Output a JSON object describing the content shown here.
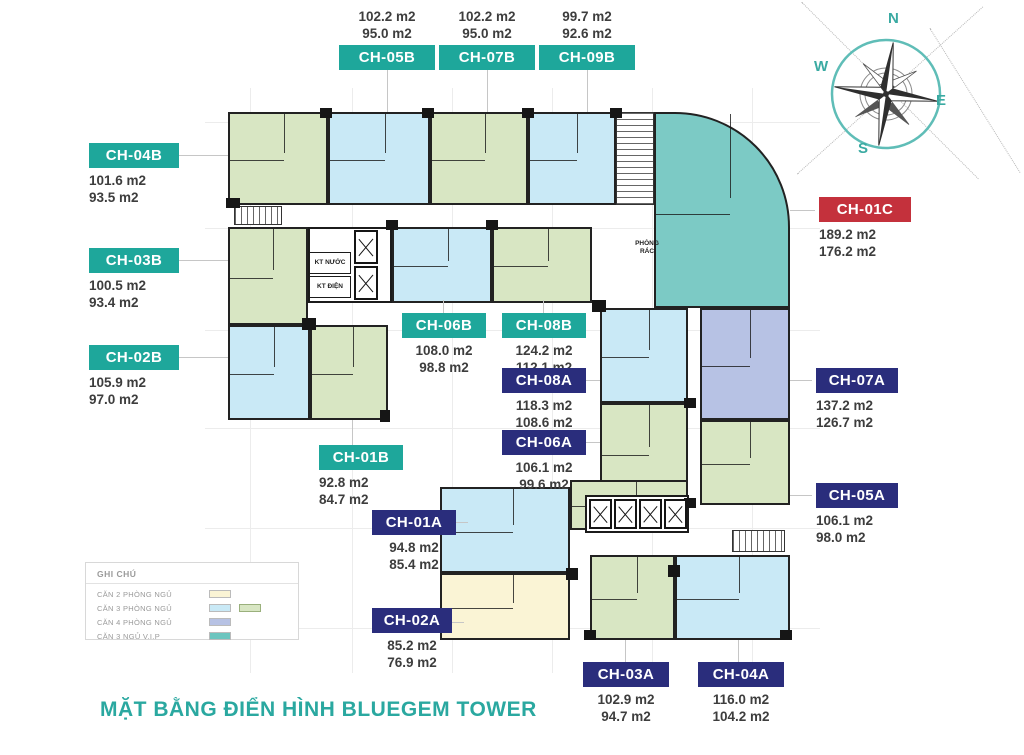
{
  "title": "MẶT BẰNG ĐIỂN HÌNH BLUEGEM TOWER",
  "compass": {
    "n": "N",
    "e": "E",
    "s": "S",
    "w": "W"
  },
  "legend": {
    "title": "GHI CHÚ",
    "items": [
      {
        "label": "CĂN 2 PHÒNG NGỦ"
      },
      {
        "label": "CĂN 3 PHÒNG NGỦ"
      },
      {
        "label": "CĂN 4 PHÒNG NGỦ"
      },
      {
        "label": "CĂN 3 NGỦ V.I.P"
      }
    ]
  },
  "plan_labels": {
    "kt_nuoc": "KT NƯỚC",
    "kt_dien": "KT ĐIỆN",
    "phong_rac": "PHÒNG RÁC"
  },
  "units": [
    {
      "code": "CH-05B",
      "area_gross": "102.2 m2",
      "area_net": "95.0 m2"
    },
    {
      "code": "CH-07B",
      "area_gross": "102.2 m2",
      "area_net": "95.0 m2"
    },
    {
      "code": "CH-09B",
      "area_gross": "99.7 m2",
      "area_net": "92.6 m2"
    },
    {
      "code": "CH-04B",
      "area_gross": "101.6 m2",
      "area_net": "93.5 m2"
    },
    {
      "code": "CH-03B",
      "area_gross": "100.5 m2",
      "area_net": "93.4 m2"
    },
    {
      "code": "CH-02B",
      "area_gross": "105.9 m2",
      "area_net": "97.0 m2"
    },
    {
      "code": "CH-01C",
      "area_gross": "189.2 m2",
      "area_net": "176.2 m2"
    },
    {
      "code": "CH-06B",
      "area_gross": "108.0 m2",
      "area_net": "98.8 m2"
    },
    {
      "code": "CH-08B",
      "area_gross": "124.2 m2",
      "area_net": "112.1 m2"
    },
    {
      "code": "CH-08A",
      "area_gross": "118.3 m2",
      "area_net": "108.6 m2"
    },
    {
      "code": "CH-06A",
      "area_gross": "106.1 m2",
      "area_net": "99.6 m2"
    },
    {
      "code": "CH-07A",
      "area_gross": "137.2 m2",
      "area_net": "126.7 m2"
    },
    {
      "code": "CH-05A",
      "area_gross": "106.1 m2",
      "area_net": "98.0 m2"
    },
    {
      "code": "CH-01B",
      "area_gross": "92.8 m2",
      "area_net": "84.7 m2"
    },
    {
      "code": "CH-01A",
      "area_gross": "94.8 m2",
      "area_net": "85.4 m2"
    },
    {
      "code": "CH-02A",
      "area_gross": "85.2 m2",
      "area_net": "76.9 m2"
    },
    {
      "code": "CH-03A",
      "area_gross": "102.9 m2",
      "area_net": "94.7 m2"
    },
    {
      "code": "CH-04A",
      "area_gross": "116.0 m2",
      "area_net": "104.2 m2"
    }
  ],
  "colors": {
    "badge_teal": "#1ea79b",
    "badge_navy": "#2a2d7c",
    "badge_red": "#c4313c",
    "fill_green": "#d8e6c3",
    "fill_blue": "#c9e9f6",
    "fill_yellow": "#faf4d5",
    "fill_periwinkle": "#b7c2e4",
    "fill_teal_vip": "#7ccac5",
    "title_teal": "#2aa8a0"
  }
}
